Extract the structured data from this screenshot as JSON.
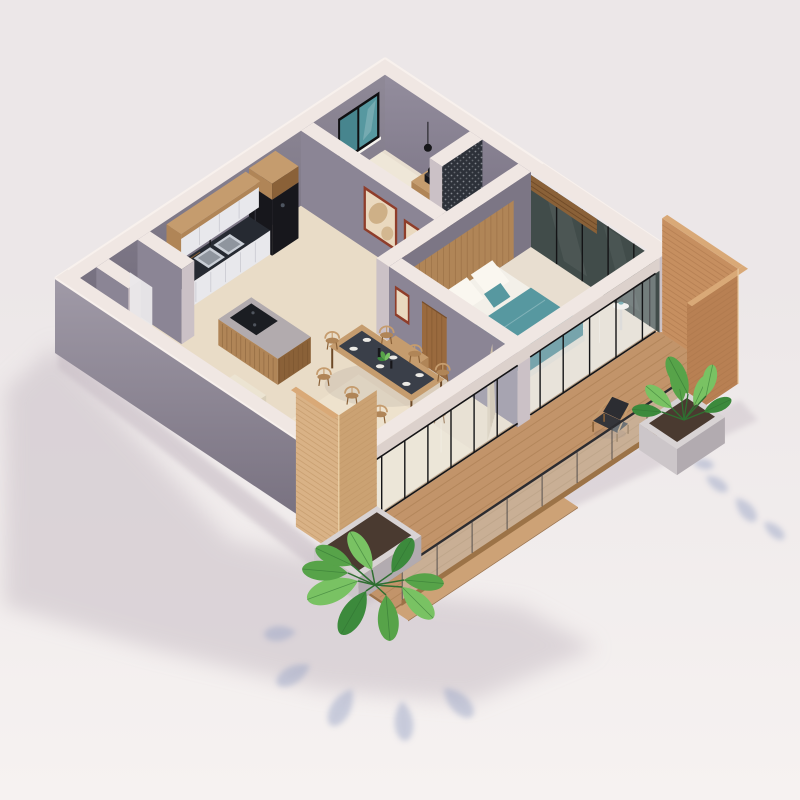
{
  "scene": {
    "title": "Isometric 3D floor plan render of a one-bedroom apartment with terrace deck",
    "view": "isometric cutaway, no roof",
    "objects": [
      {
        "id": "kitchen",
        "label": "kitchen with cabinets, double sink and refrigerator"
      },
      {
        "id": "kitchen-island",
        "label": "kitchen island with cooktop"
      },
      {
        "id": "dining-area",
        "label": "dining table with wishbone chairs"
      },
      {
        "id": "living-area",
        "label": "living area with cream sofa and stool"
      },
      {
        "id": "bedroom-main",
        "label": "main bedroom with teal bed and glass walls"
      },
      {
        "id": "bedroom-second",
        "label": "second bedroom with window and nightstand"
      },
      {
        "id": "bathroom",
        "label": "bathroom with dark mosaic accent wall"
      },
      {
        "id": "hallway",
        "label": "hallway with framed artwork"
      },
      {
        "id": "storage-rooms",
        "label": "storage rooms at west corner"
      },
      {
        "id": "terrace-deck",
        "label": "wooden terrace deck with glass railing"
      },
      {
        "id": "lounge-chair",
        "label": "outdoor lounge chair"
      },
      {
        "id": "privacy-screen-terracotta",
        "label": "tall terracotta slat privacy screen"
      },
      {
        "id": "privacy-screen-light-wood",
        "label": "light wood slat privacy screen"
      },
      {
        "id": "planter-monstera",
        "label": "concrete planter with monstera"
      },
      {
        "id": "planter-alocasia",
        "label": "concrete planter with alocasia"
      },
      {
        "id": "sliding-glass-doors",
        "label": "black framed sliding glass doors"
      },
      {
        "id": "window",
        "label": "black framed window with teal glazing"
      },
      {
        "id": "art-frames",
        "label": "rust framed abstract artwork"
      },
      {
        "id": "curtain",
        "label": "beige floor curtain"
      },
      {
        "id": "building-shadow",
        "label": "soft ground shadow cast to the south-west"
      }
    ]
  },
  "palette": {
    "bg1": "#ECE7E8",
    "bg2": "#F6F2F1",
    "shadow": "#D2C9CF",
    "shadowDeep": "#C0B4BE",
    "plantShadow": "#9BA6C6",
    "wallTop": "#F0E7E3",
    "faceSW": "#8B8595",
    "faceSE": "#7C7685",
    "faceCap": "#CBC1C6",
    "gSWa": "#A09AA7",
    "gSWb": "#746D7C",
    "gNWa": "#8F8997",
    "gNWb": "#6F6979",
    "gNEa": "#938D9D",
    "gNEb": "#766F80",
    "edgeHi": "#F8F1ED",
    "floorMain": "#E9DCC7",
    "floorLight": "#F2E7D2",
    "floorBed": "#E8DED0",
    "floorBath": "#E0D6CC",
    "rug": "#F0E8DA",
    "deckWood": "#C2946A",
    "deckStripe": "#A87C50",
    "deckEdge": "#9E734A",
    "deckStep": "#CDA276",
    "wood": "#B08557",
    "woodTop": "#C59C6E",
    "woodDark": "#8A6138",
    "woodDeep": "#6E4A28",
    "terra": "#C68F60",
    "terraDk": "#A9744A",
    "terraSide": "#B88053",
    "terraTop": "#D9A977",
    "slatLight": "#D9B286",
    "slatLightDk": "#BE9465",
    "slatLight2": "#CBA273",
    "cabWhite": "#E8E8EC",
    "cabWhite2": "#DBDBE1",
    "counter": "#262A32",
    "steel": "#C9CED6",
    "steelDk": "#8F959E",
    "fridge": "#17171C",
    "fridgeHi": "#33333C",
    "frameRust": "#8F3D2A",
    "artBg": "#EAD9BF",
    "artTan": "#C9A87C",
    "door": "#9A6A3E",
    "doorDk": "#774E2B",
    "glassDark": "#414C4A",
    "mull": "#141416",
    "glassPane": "#E9F0F1",
    "beamFace": "#DCD1CC",
    "teal": "#5798A0",
    "tealDk": "#47858E",
    "bedWhite": "#F3F0E9",
    "bedShade": "#DDD8CE",
    "duvet": "#EFEBE2",
    "sofa": "#ECE4D2",
    "sofaDk": "#D9CFBA",
    "pillow": "#FAF7F0",
    "g1": "#57A349",
    "g2": "#79C263",
    "g3": "#3C8A3C",
    "stem": "#2F6F31",
    "planter": "#CCC6C9",
    "planterDk": "#B2ABB0",
    "planterTop": "#D8D3D4",
    "soil": "#4A3A30",
    "mosaic": "#2D3139",
    "mosaicDot": "#C8CBD1",
    "railGlass": "#D7E2E4",
    "railFrame": "#2C2C30",
    "railBase": "#9C7347",
    "curtain": "#D8CAB4",
    "curtainDk": "#C4B49C",
    "islandTop": "#B2ABAE",
    "cooktop": "#1B1D22",
    "white": "#F6F3EE",
    "black": "#17171A"
  }
}
